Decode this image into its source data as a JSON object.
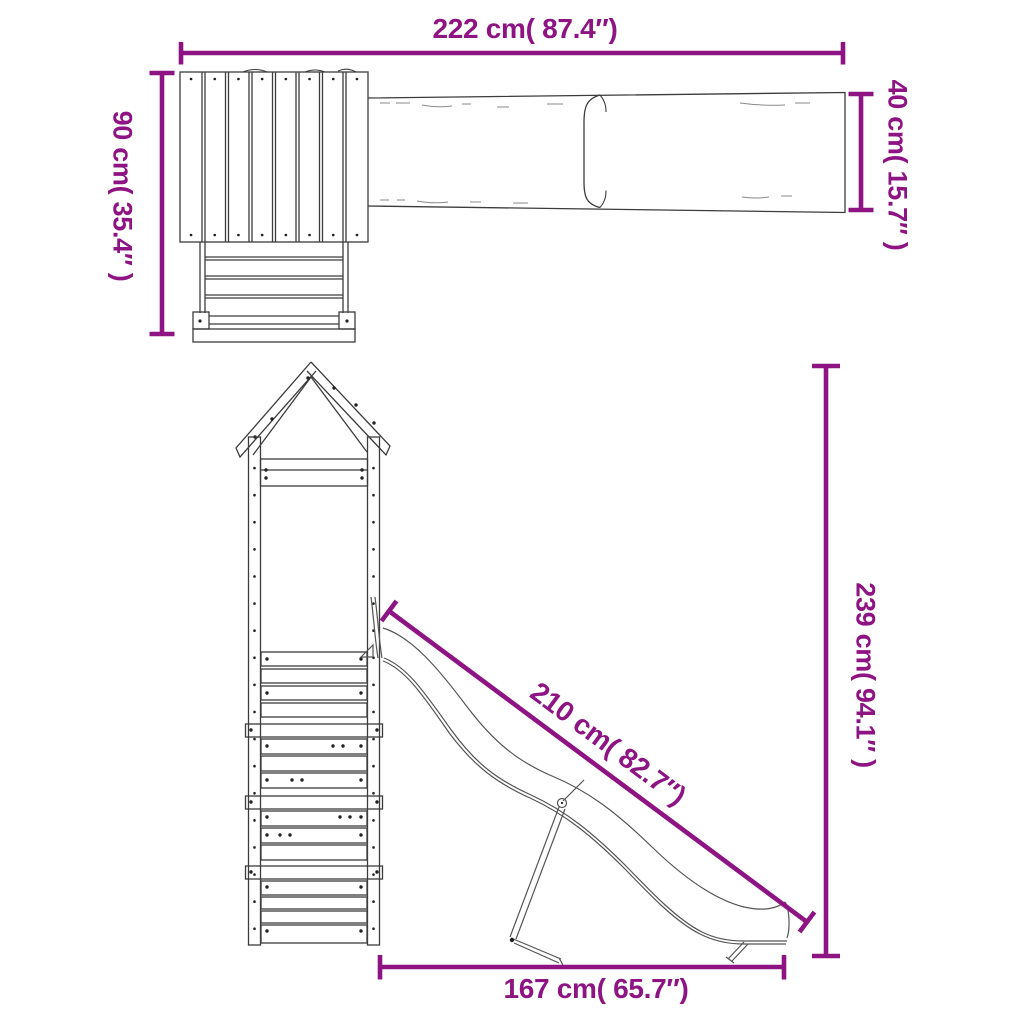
{
  "diagram": {
    "kind": "playset dimension drawing",
    "views": {
      "plan": "top view of tower roof, ladder and slide",
      "elevation": "side view of tower with slide and support leg"
    }
  },
  "dimensions": {
    "overall_width": {
      "label": "222 cm( 87.4″)"
    },
    "slide_width": {
      "label": "40 cm( 15.7″ )"
    },
    "tower_depth": {
      "label": "90 cm( 35.4″ )"
    },
    "overall_height": {
      "label": "239 cm( 94.1″ )"
    },
    "slide_length": {
      "label": "210 cm( 82.7″)"
    },
    "footprint_length": {
      "label": "167 cm( 65.7″)"
    }
  },
  "colors": {
    "dimension_lines": "#8E1484",
    "drawing_lines": "#3C3C3C",
    "background": "#FFFFFF"
  }
}
